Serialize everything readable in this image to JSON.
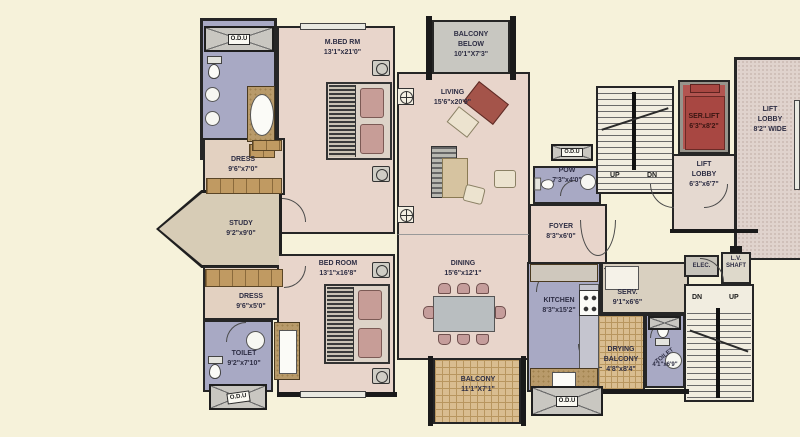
{
  "rooms": {
    "mbed": {
      "name": "M.BED RM",
      "dims": "13'1\"x21'0\""
    },
    "balcony_below": {
      "name": "BALCONY BELOW",
      "dims": "10'1\"X7'3\""
    },
    "living": {
      "name": "LIVING",
      "dims": "15'6\"x20'9\""
    },
    "dress_upper": {
      "name": "DRESS",
      "dims": "9'6\"x7'0\""
    },
    "study": {
      "name": "STUDY",
      "dims": "9'2\"x9'0\""
    },
    "dress_lower": {
      "name": "DRESS",
      "dims": "9'6\"x5'0\""
    },
    "toilet_master": {
      "name": "TOILET",
      "dims": "9'2\"x7'10\""
    },
    "bedroom": {
      "name": "BED ROOM",
      "dims": "13'1\"x16'8\""
    },
    "dining": {
      "name": "DINING",
      "dims": "15'6\"x12'1\""
    },
    "balcony": {
      "name": "BALCONY",
      "dims": "11'1\"X7'1\""
    },
    "pow": {
      "name": "POW",
      "dims": "7'3\"x4'0\""
    },
    "foyer": {
      "name": "FOYER",
      "dims": "8'3\"x6'0\""
    },
    "kitchen": {
      "name": "KITCHEN",
      "dims": "8'3\"x15'2\""
    },
    "serv": {
      "name": "SERV.",
      "dims": "9'1\"x6'6\""
    },
    "drying_balcony": {
      "name": "DRYING BALCONY",
      "dims": "4'8\"x8'4\""
    },
    "toilet_common": {
      "name": "TOILET",
      "dims": "4'1\"x6'9\""
    },
    "ser_lift": {
      "name": "SER.LIFT",
      "dims": "6'3\"x8'2\""
    },
    "lift_lobby": {
      "name": "LIFT LOBBY",
      "dims": "6'3\"x6'7\""
    },
    "lift_lobby_wide": {
      "name": "LIFT LOBBY",
      "dims": "8'2\" WIDE"
    },
    "elec": {
      "name": "ELEC."
    },
    "lv_shaft": {
      "name": "L.V. SHAFT"
    }
  },
  "markers": {
    "odu": "O.D.U",
    "up": "UP",
    "dn": "DN"
  },
  "colors": {
    "background": "#f6f2da",
    "room_pink": "#e8d5cb",
    "wet_lavender": "#a8a9c4",
    "balcony_tan": "#d9bd90",
    "balcony_gray": "#c8c7c1",
    "lift_red": "#b25450",
    "study_tan": "#d7ccb6",
    "wall": "#1a1a1a",
    "label_text": "#2e2e44"
  }
}
